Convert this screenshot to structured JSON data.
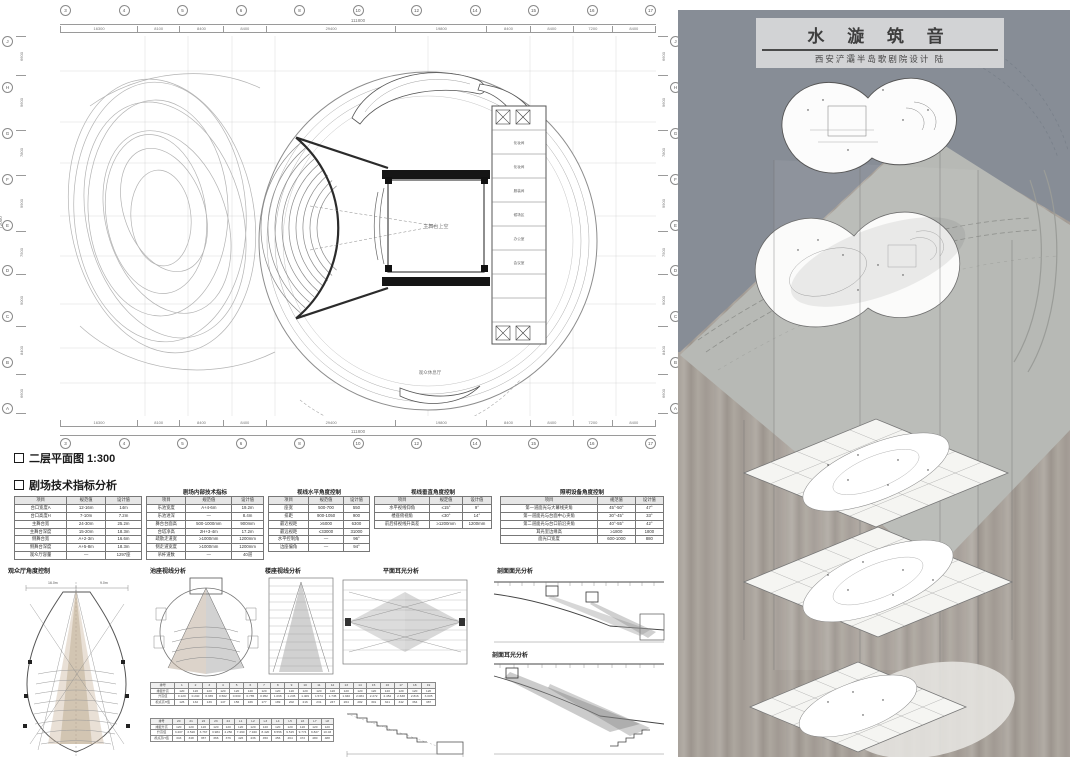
{
  "poster": {
    "title": "水 漩 筑 音",
    "subtitle": "西安浐灞半岛歌剧院设计  陆",
    "colors": {
      "sky": "#878d96",
      "plate": "#b7b9b5",
      "wash": "#a8a29c",
      "accent_tan": "#c7b299"
    }
  },
  "plan": {
    "section_label": "二层平面图 1:300",
    "stage_label": "主舞台上空",
    "lounge_label": "观众休息厅",
    "rooms": [
      "化妆间",
      "化妆间",
      "服装间",
      "候场区",
      "办公室",
      "会议室"
    ],
    "dims": {
      "top_total": "111800",
      "top_segments": [
        "16300",
        "8100",
        "8400",
        "8400",
        "29400",
        "19800",
        "8400",
        "8400",
        "7200",
        "8400"
      ],
      "bottom_total": "111800",
      "bottom_segments": [
        "16300",
        "8100",
        "8400",
        "8400",
        "29400",
        "19800",
        "8400",
        "8400",
        "7200",
        "8400"
      ],
      "left_total": "72000",
      "left_segments": [
        "6600",
        "9600",
        "7800",
        "9900",
        "7500",
        "9000",
        "8400",
        "6600"
      ],
      "right_total": "72000",
      "right_segments": [
        "6600",
        "9600",
        "7800",
        "9900",
        "7500",
        "9000",
        "8400",
        "6600"
      ],
      "top_bubbles": [
        "3",
        "4",
        "5",
        "6",
        "8",
        "10",
        "12",
        "14",
        "15",
        "16",
        "17"
      ],
      "bottom_bubbles": [
        "3",
        "4",
        "5",
        "6",
        "8",
        "10",
        "12",
        "14",
        "15",
        "16",
        "17"
      ],
      "left_bubbles": [
        "J",
        "H",
        "G",
        "F",
        "E",
        "D",
        "C",
        "B",
        "A"
      ],
      "right_bubbles": [
        "J",
        "H",
        "G",
        "F",
        "E",
        "D",
        "C",
        "B",
        "A"
      ]
    }
  },
  "analysis": {
    "section_label": "剧场技术指标分析",
    "captions": [
      "观众厅角度控制",
      "池座视线分析",
      "楼座视线分析",
      "平面耳光分析",
      "剖面面光分析",
      "剖面耳光分析"
    ],
    "d1_dims": [
      "16.0m",
      "9.0m"
    ],
    "tables": {
      "t1": {
        "headers": [
          "项目",
          "规范值",
          "设计值"
        ],
        "rows": [
          [
            "台口宽度A",
            "12-16m",
            "14m"
          ],
          [
            "台口高度H",
            "7-10m",
            "7.2m"
          ],
          [
            "主舞台宽",
            "24-30m",
            "25.2m"
          ],
          [
            "主舞台深度",
            "15-20m",
            "18.3m"
          ],
          [
            "侧舞台宽",
            "A+2-3m",
            "16.6m"
          ],
          [
            "侧舞台深度",
            "A+5-8m",
            "18.3m"
          ],
          [
            "观众厅容量",
            "—",
            "1297座"
          ]
        ]
      },
      "t2": {
        "title": "剧场内部技术指标",
        "headers": [
          "项目",
          "规范值",
          "设计值"
        ],
        "rows": [
          [
            "乐池宽度",
            "A+4-6m",
            "19.2m"
          ],
          [
            "乐池进深",
            "—",
            "8.4m"
          ],
          [
            "舞台台面高",
            "500-1000mm",
            "900mm"
          ],
          [
            "台塔净高",
            "2H+3-4m",
            "17.2m"
          ],
          [
            "疏散走道宽",
            "≥1000mm",
            "1200mm"
          ],
          [
            "侧走道宽度",
            "≥1000mm",
            "1200mm"
          ],
          [
            "吊杆道数",
            "—",
            "40道"
          ]
        ]
      },
      "t3": {
        "title": "视线水平角度控制",
        "headers": [
          "项目",
          "规范值",
          "设计值"
        ],
        "rows": [
          [
            "座宽",
            "500-700",
            "550"
          ],
          [
            "排距",
            "900-1050",
            "900"
          ],
          [
            "最近视距",
            "≥5000",
            "6300"
          ],
          [
            "最远视距",
            "≤33000",
            "31000"
          ],
          [
            "水平控制角",
            "—",
            "96°"
          ],
          [
            "边座偏角",
            "—",
            "94°"
          ]
        ]
      },
      "t4": {
        "title": "视线垂直角度控制",
        "headers": [
          "项目",
          "规定值",
          "设计值"
        ],
        "rows": [
          [
            "水平视线仰角",
            "≤15°",
            "9°"
          ],
          [
            "楼座俯视角",
            "≤30°",
            "14°"
          ],
          [
            "前后排视线升高差",
            "≥1200mm",
            "1200mm"
          ]
        ]
      },
      "t5": {
        "title": "照明设备角度控制",
        "headers": [
          "项目",
          "规范值",
          "设计值"
        ],
        "rows": [
          [
            "第一道面光与大幕线夹角",
            "45°-50°",
            "47°"
          ],
          [
            "第一道面光与台面中心夹角",
            "30°-45°",
            "33°"
          ],
          [
            "第二道面光与台口前沿夹角",
            "40°-55°",
            "42°"
          ],
          [
            "耳光室边缘高",
            "≥1800",
            "1800"
          ],
          [
            "面光口宽度",
            "600-1000",
            "880"
          ]
        ]
      },
      "strip1": {
        "headers": [
          "排号",
          "1",
          "2",
          "3",
          "4",
          "5",
          "6",
          "7",
          "8",
          "9",
          "10",
          "11",
          "12",
          "13",
          "14",
          "15",
          "16",
          "17",
          "18",
          "19"
        ],
        "rows": [
          [
            "排距升高",
            "120",
            "120",
            "120",
            "120",
            "120",
            "120",
            "120",
            "120",
            "120",
            "120",
            "120",
            "120",
            "120",
            "120",
            "120",
            "120",
            "120",
            "120",
            "120"
          ],
          [
            "升高值",
            "0.120",
            "0.240",
            "0.365",
            "0.502",
            "0.630",
            "0.785",
            "0.952",
            "1.096",
            "1.245",
            "1.409",
            "1.574",
            "1.745",
            "1.940",
            "2.084",
            "2.272",
            "2.452",
            "2.638",
            "2.816",
            "3.005"
          ],
          [
            "视点高H值",
            "126",
            "132",
            "139",
            "147",
            "156",
            "166",
            "177",
            "189",
            "202",
            "216",
            "231",
            "247",
            "264",
            "282",
            "301",
            "321",
            "342",
            "364",
            "387"
          ]
        ]
      },
      "strip2": {
        "headers": [
          "排号",
          "20",
          "21",
          "22",
          "23",
          "24",
          "L1",
          "L2",
          "L3",
          "L4",
          "L5",
          "L6",
          "L7",
          "L8"
        ],
        "rows": [
          [
            "排距升高",
            "120",
            "120",
            "120",
            "120",
            "120",
            "120",
            "120",
            "120",
            "120",
            "120",
            "120",
            "120",
            "120"
          ],
          [
            "升高值",
            "3.207",
            "3.520",
            "3.767",
            "3.984",
            "4.250",
            "7.490",
            "7.940",
            "8.420",
            "8.556",
            "9.515",
            "9.774",
            "9.827",
            "10.03"
          ],
          [
            "视点高H值",
            "343",
            "348",
            "357",
            "366",
            "376",
            "426",
            "436",
            "450",
            "456",
            "464",
            "472",
            "480",
            "488"
          ]
        ]
      }
    }
  }
}
